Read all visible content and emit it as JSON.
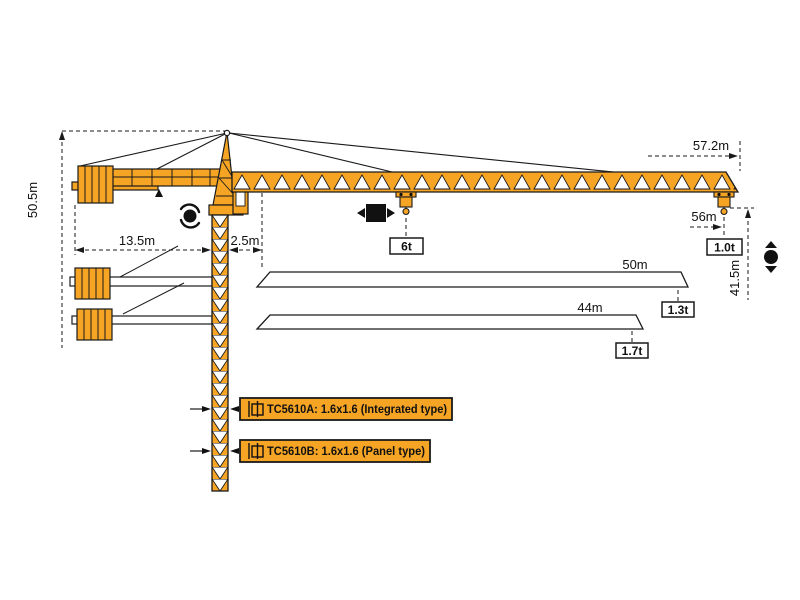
{
  "diagram": {
    "name": "tower-crane-working-range-diagram",
    "colors": {
      "crane_orange": "#F5A424",
      "outline": "#1A1A1A",
      "background": "#FFFFFF"
    },
    "dims": {
      "overall_height": "50.5m",
      "counter_jib_radius": "13.5m",
      "slew_offset": "2.5m",
      "jib_tip_distance": "57.2m",
      "working_radius": "56m",
      "height_under_hook": "41.5m"
    },
    "loads": {
      "max_load": "6t",
      "tip_load_56m": "1.0t",
      "tip_load_50m": "1.3t",
      "tip_load_44m": "1.7t"
    },
    "variants": {
      "jib_50": "50m",
      "jib_44": "44m"
    },
    "models": {
      "a": "TC5610A: 1.6x1.6 (Integrated type)",
      "b": "TC5610B: 1.6x1.6 (Panel type)"
    },
    "icons": {
      "slewing": "slewing-rotation-icon",
      "trolley": "trolley-travel-icon",
      "hoist": "hoist-up-down-icon",
      "mast_section": "mast-section-icon"
    }
  }
}
